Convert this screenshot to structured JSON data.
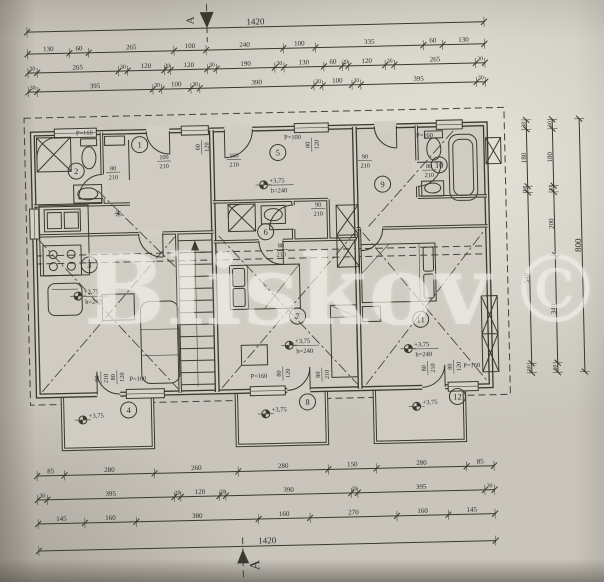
{
  "watermark": {
    "text": "Bliskov",
    "copyright": "©"
  },
  "section_markers": {
    "top": "A",
    "bottom": "A"
  },
  "plan": {
    "rooms": [
      {
        "n": "1",
        "cx": 143,
        "cy": 141
      },
      {
        "n": "2",
        "cx": 79,
        "cy": 166
      },
      {
        "n": "3",
        "cx": 90,
        "cy": 260
      },
      {
        "n": "4",
        "cx": 126,
        "cy": 406
      },
      {
        "n": "5",
        "cx": 281,
        "cy": 152
      },
      {
        "n": "6",
        "cx": 267,
        "cy": 231
      },
      {
        "n": "7",
        "cx": 297,
        "cy": 316
      },
      {
        "n": "8",
        "cx": 305,
        "cy": 402
      },
      {
        "n": "9",
        "cx": 385,
        "cy": 186
      },
      {
        "n": "10",
        "cx": 442,
        "cy": 168
      },
      {
        "n": "11",
        "cx": 420,
        "cy": 322
      },
      {
        "n": "12",
        "cx": 455,
        "cy": 400
      }
    ],
    "levels": [
      {
        "x": 78,
        "y": 291,
        "l1": "+3,75",
        "l2": "h=240"
      },
      {
        "x": 266,
        "y": 184,
        "l1": "+3,75",
        "l2": "h=240"
      },
      {
        "x": 288,
        "y": 345,
        "l1": "+3,75",
        "l2": "h=240"
      },
      {
        "x": 407,
        "y": 351,
        "l1": "+3,75",
        "l2": "h=240"
      },
      {
        "x": 80,
        "y": 415,
        "l1": "+3,75"
      },
      {
        "x": 263,
        "y": 413,
        "l1": "+3,75"
      },
      {
        "x": 414,
        "y": 409,
        "l1": "+3,75"
      }
    ],
    "labels": [
      {
        "x": 116,
        "y": 166,
        "t": "80",
        "b": "210"
      },
      {
        "x": 167,
        "y": 156,
        "t": "100",
        "b": "210"
      },
      {
        "x": 237,
        "y": 156,
        "t": "100",
        "b": "210"
      },
      {
        "x": 320,
        "y": 207,
        "t": "90",
        "b": "210"
      },
      {
        "x": 282,
        "y": 247,
        "t": "80",
        "b": "210"
      },
      {
        "x": 368,
        "y": 160,
        "t": "90",
        "b": "210"
      },
      {
        "x": 432,
        "y": 171,
        "t": "80",
        "b": "210"
      },
      {
        "x": 97,
        "y": 374,
        "t": "80",
        "b": "210",
        "rot": -90
      },
      {
        "x": 113,
        "y": 373,
        "t": "80",
        "b": "120",
        "rot": -90
      },
      {
        "x": 136,
        "y": 377,
        "t": "P=160"
      },
      {
        "x": 257,
        "y": 377,
        "t": "P=160"
      },
      {
        "x": 279,
        "y": 373,
        "t": "80",
        "b": "120",
        "rot": -90
      },
      {
        "x": 318,
        "y": 375,
        "t": "80",
        "b": "210",
        "rot": -90
      },
      {
        "x": 424,
        "y": 371,
        "t": "80",
        "b": "210",
        "rot": -90
      },
      {
        "x": 450,
        "y": 370,
        "t": "80",
        "b": "120",
        "rot": -90
      },
      {
        "x": 470,
        "y": 371,
        "t": "P=160"
      },
      {
        "x": 88,
        "y": 130,
        "t": "P=160"
      },
      {
        "x": 296,
        "y": 139,
        "t": "P=100"
      },
      {
        "x": 313,
        "y": 145,
        "t": "80",
        "b": "120",
        "rot": -90
      },
      {
        "x": 203,
        "y": 145,
        "t": "60",
        "b": "120",
        "rot": -90
      },
      {
        "x": 428,
        "y": 140,
        "t": "P=160"
      }
    ],
    "symbols": [
      {
        "name": "light-point-symbol",
        "glyph": "✳",
        "x": 120,
        "y": 213
      }
    ]
  },
  "dimensions": {
    "chains": [
      {
        "name": "dim-top-overall",
        "dir": "h",
        "x0": 33,
        "x1": 490,
        "y": 26,
        "values": [
          "1420"
        ],
        "labelSize": 9
      },
      {
        "name": "dim-top-row1",
        "dir": "h",
        "x0": 33,
        "x1": 490,
        "y": 48,
        "values": [
          "130",
          "60",
          "265",
          "100",
          "240",
          "100",
          "335",
          "60",
          "130"
        ]
      },
      {
        "name": "dim-top-row2",
        "dir": "h",
        "x0": 33,
        "x1": 490,
        "y": 67,
        "values": [
          "30",
          "265",
          "30",
          "120",
          "20",
          "120",
          "30",
          "190",
          "30",
          "130",
          "60",
          "20",
          "120",
          "30",
          "265",
          "30"
        ]
      },
      {
        "name": "dim-top-row3",
        "dir": "h",
        "x0": 33,
        "x1": 490,
        "y": 86,
        "values": [
          "30",
          "395",
          "30",
          "100",
          "30",
          "390",
          "30",
          "100",
          "30",
          "395",
          "30"
        ]
      },
      {
        "name": "dim-bottom-row1",
        "dir": "h",
        "x0": 33,
        "x1": 490,
        "y": 470,
        "values": [
          "85",
          "280",
          "260",
          "280",
          "150",
          "280",
          "85"
        ]
      },
      {
        "name": "dim-bottom-row2",
        "dir": "h",
        "x0": 33,
        "x1": 490,
        "y": 494,
        "values": [
          "30",
          "395",
          "20",
          "120",
          "20",
          "390",
          "20",
          "395",
          "30"
        ]
      },
      {
        "name": "dim-bottom-row3",
        "dir": "h",
        "x0": 33,
        "x1": 490,
        "y": 518,
        "values": [
          "145",
          "160",
          "380",
          "160",
          "270",
          "160",
          "145"
        ]
      },
      {
        "name": "dim-bottom-overall",
        "dir": "h",
        "x0": 33,
        "x1": 490,
        "y": 545,
        "values": [
          "1420"
        ],
        "labelSize": 9
      },
      {
        "name": "dim-right-inner",
        "dir": "v",
        "y0": 125,
        "y1": 378,
        "x": 530,
        "values": [
          "30",
          "180",
          "20",
          "540",
          "30"
        ]
      },
      {
        "name": "dim-right-middle",
        "dir": "v",
        "y0": 125,
        "y1": 378,
        "x": 556,
        "values": [
          "30",
          "180",
          "20",
          "200",
          "340",
          "30"
        ]
      },
      {
        "name": "dim-right-overall",
        "dir": "v",
        "y0": 125,
        "y1": 378,
        "x": 583,
        "values": [
          "800"
        ],
        "labelSize": 9
      }
    ]
  }
}
